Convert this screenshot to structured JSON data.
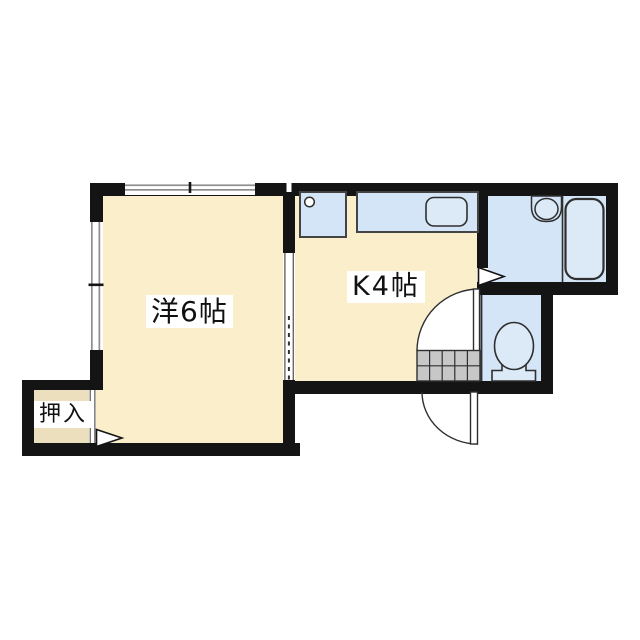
{
  "plan": {
    "type": "apartment-floor-plan",
    "rooms": [
      {
        "id": "western_room",
        "label": "洋6帖"
      },
      {
        "id": "kitchen",
        "label": "K4帖"
      },
      {
        "id": "closet",
        "label": "押入"
      },
      {
        "id": "bathroom",
        "label": ""
      },
      {
        "id": "toilet",
        "label": ""
      }
    ],
    "fixtures": [
      "stove-sink-unit-icon",
      "kitchen-counter-sink-icon",
      "wash-basin-icon",
      "bathtub-icon",
      "toilet-icon",
      "entrance-step-hatch-icon",
      "entrance-door-swing-icon",
      "toilet-door-swing-icon",
      "closet-sliding-door-icon",
      "door-direction-arrow-icon",
      "window-icon"
    ]
  },
  "rooms": {
    "western_room": {
      "label": "洋6帖"
    },
    "kitchen": {
      "label": "K4帖"
    },
    "closet": {
      "label": "押入"
    }
  },
  "colors": {
    "background": "#ffffff",
    "wall": "#141414",
    "room_fill": "#faeecb",
    "closet_fill": "#ecdfbd",
    "water_fill": "#d3e5f6",
    "fixture_fill": "#dceaf8",
    "hatch_fill": "#c7c7c7",
    "window_line": "#8f8f8f",
    "outline": "#2f2f2f"
  }
}
